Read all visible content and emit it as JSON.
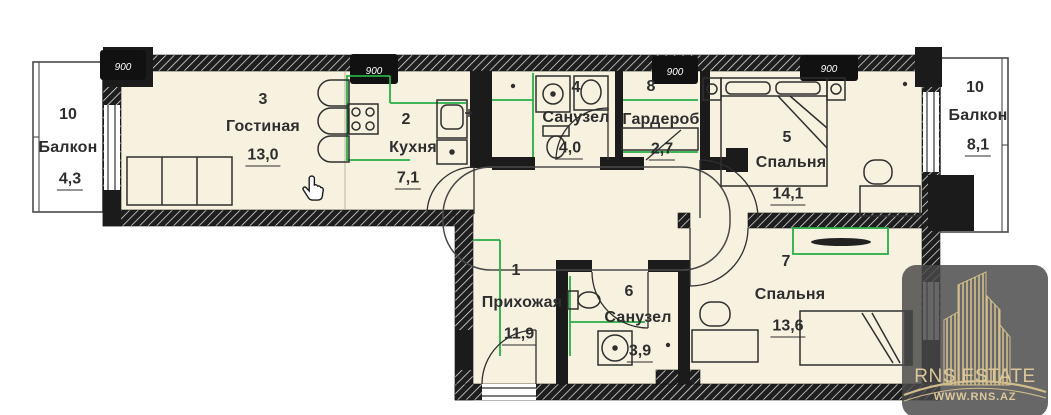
{
  "plan": {
    "rooms": [
      {
        "id": "living",
        "number": "3",
        "name": "Гостиная",
        "area": "13,0"
      },
      {
        "id": "kitchen",
        "number": "2",
        "name": "Кухня",
        "area": "7,1"
      },
      {
        "id": "bath-main",
        "number": "4",
        "name": "Санузел",
        "area": "4,0"
      },
      {
        "id": "wardrobe",
        "number": "8",
        "name": "Гардероб",
        "area": "2,7"
      },
      {
        "id": "bedroom-1",
        "number": "5",
        "name": "Спальня",
        "area": "14,1"
      },
      {
        "id": "hallway",
        "number": "1",
        "name": "Прихожая",
        "area": "11,9"
      },
      {
        "id": "bath-small",
        "number": "6",
        "name": "Санузел",
        "area": "3,9"
      },
      {
        "id": "bedroom-2",
        "number": "7",
        "name": "Спальня",
        "area": "13,6"
      },
      {
        "id": "balcony-left",
        "number": "10",
        "name": "Балкон",
        "area": "4,3"
      },
      {
        "id": "balcony-right",
        "number": "10",
        "name": "Балкон",
        "area": "8,1"
      }
    ],
    "dimension_tags": [
      {
        "label": "900"
      },
      {
        "label": "900"
      },
      {
        "label": "900"
      },
      {
        "label": "900"
      }
    ],
    "colors": {
      "room_fill": "#f6f2df",
      "wall": "#1b1b1b",
      "accent_green": "#27ae45",
      "balcony_fill": "#ffffff"
    }
  },
  "watermark": {
    "title": "RNS ESTATE",
    "url": "WWW.RNS.AZ",
    "gold": "#d2bd8c",
    "bg": "#484848"
  }
}
